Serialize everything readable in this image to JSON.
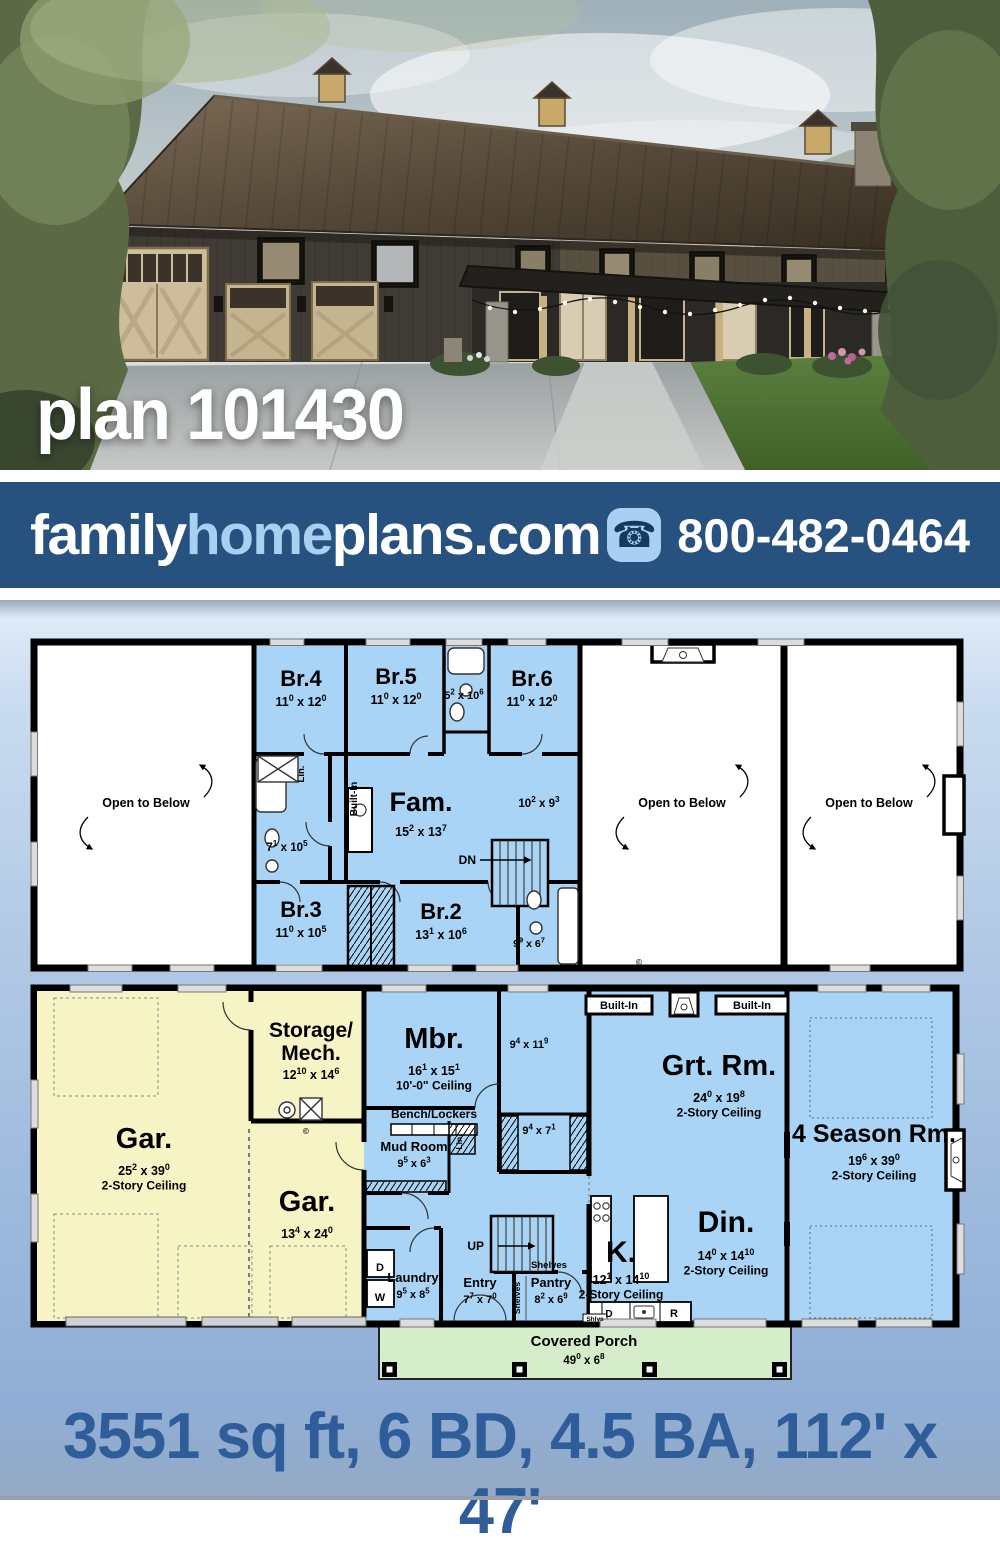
{
  "photo": {
    "title": "plan 101430"
  },
  "banner": {
    "logo_family": "family",
    "logo_home": "home",
    "logo_plans": "plans.com",
    "phone_icon": "phone-icon",
    "phone": "800-482-0464",
    "background": "#27517e",
    "accent": "#a9cff3"
  },
  "footer": {
    "stats": "3551 sq ft, 6 BD, 4.5 BA, 112' x 47'",
    "color": "#2e5d99"
  },
  "colors": {
    "room_fill": "#a9d4f5",
    "garage_fill": "#f6f3c5",
    "porch_fill": "#d6edcb",
    "open_fill": "#ffffff",
    "wall": "#000000"
  },
  "plans": {
    "upper": {
      "labels": [
        {
          "x": 271,
          "y": 48,
          "name": "Br.4",
          "fs": 22,
          "dims": [
            "11",
            "0",
            "12",
            "0"
          ]
        },
        {
          "x": 366,
          "y": 46,
          "name": "Br.5",
          "fs": 22,
          "dims": [
            "11",
            "0",
            "12",
            "0"
          ]
        },
        {
          "x": 434,
          "y": 61,
          "dims": [
            "5",
            "2",
            "10",
            "6"
          ],
          "dfs": 11
        },
        {
          "x": 502,
          "y": 48,
          "name": "Br.6",
          "fs": 22,
          "dims": [
            "11",
            "0",
            "12",
            "0"
          ]
        },
        {
          "x": 391,
          "y": 173,
          "name": "Fam.",
          "fs": 27,
          "dims": [
            "15",
            "2",
            "13",
            "7"
          ]
        },
        {
          "x": 509,
          "y": 169,
          "dims": [
            "10",
            "2",
            "9",
            "3"
          ],
          "dfs": 11.5
        },
        {
          "x": 257,
          "y": 213,
          "dims": [
            "7",
            "1",
            "10",
            "5"
          ],
          "dfs": 11.5
        },
        {
          "x": 271,
          "y": 279,
          "name": "Br.3",
          "fs": 22,
          "dims": [
            "11",
            "0",
            "10",
            "5"
          ]
        },
        {
          "x": 411,
          "y": 281,
          "name": "Br.2",
          "fs": 22,
          "dims": [
            "13",
            "1",
            "10",
            "6"
          ]
        },
        {
          "x": 499,
          "y": 309,
          "dims": [
            "9",
            "9",
            "6",
            "7"
          ],
          "dfs": 10.5
        },
        {
          "x": 116,
          "y": 169,
          "name": "Open to Below",
          "fs": 12.5
        },
        {
          "x": 652,
          "y": 169,
          "name": "Open to Below",
          "fs": 12.5
        },
        {
          "x": 839,
          "y": 169,
          "name": "Open to Below",
          "fs": 12.5
        },
        {
          "x": 446,
          "y": 226,
          "name": "DN",
          "fs": 12,
          "anchor": "end"
        },
        {
          "x": 274,
          "y": 136,
          "name": "Lin.",
          "fs": 9.5,
          "rot": -90
        },
        {
          "x": 327,
          "y": 161,
          "name": "Built-In",
          "fs": 10,
          "rot": -90
        },
        {
          "x": 609,
          "y": 327,
          "name": "©",
          "fs": 8
        }
      ]
    },
    "main": {
      "labels": [
        {
          "x": 114,
          "y": 164,
          "name": "Gar.",
          "fs": 29,
          "dims": [
            "25",
            "2",
            "39",
            "0"
          ],
          "note": "2-Story Ceiling"
        },
        {
          "x": 281,
          "y": 53,
          "lines": [
            "Storage/",
            "Mech."
          ],
          "fs": 21,
          "dims": [
            "12",
            "10",
            "14",
            "6"
          ]
        },
        {
          "x": 277,
          "y": 227,
          "name": "Gar.",
          "fs": 29,
          "dims": [
            "13",
            "4",
            "24",
            "0"
          ]
        },
        {
          "x": 404,
          "y": 64,
          "name": "Mbr.",
          "fs": 29,
          "dims": [
            "16",
            "1",
            "15",
            "1"
          ],
          "note": "10'-0\" Ceiling"
        },
        {
          "x": 499,
          "y": 64,
          "dims": [
            "9",
            "4",
            "11",
            "9"
          ],
          "dfs": 11
        },
        {
          "x": 404,
          "y": 134,
          "name": "Bench/Lockers",
          "fs": 12
        },
        {
          "x": 432,
          "y": 158,
          "name": "Lin.",
          "fs": 8.5,
          "rot": -90
        },
        {
          "x": 384,
          "y": 167,
          "name": "Mud Room",
          "fs": 13,
          "dims": [
            "9",
            "5",
            "6",
            "3"
          ],
          "dfs": 11,
          "dy": 16
        },
        {
          "x": 509,
          "y": 150,
          "dims": [
            "9",
            "4",
            "7",
            "1"
          ],
          "dfs": 11
        },
        {
          "x": 589,
          "y": 25,
          "name": "Built-In",
          "fs": 11
        },
        {
          "x": 722,
          "y": 25,
          "name": "Built-In",
          "fs": 11
        },
        {
          "x": 689,
          "y": 91,
          "name": "Grt. Rm.",
          "fs": 29,
          "dims": [
            "24",
            "0",
            "19",
            "8"
          ],
          "note": "2-Story Ceiling"
        },
        {
          "x": 844,
          "y": 158,
          "name": "4 Season Rm.",
          "fs": 25,
          "dims": [
            "19",
            "6",
            "39",
            "0"
          ],
          "note": "2-Story Ceiling"
        },
        {
          "x": 696,
          "y": 248,
          "name": "Din.",
          "fs": 30,
          "dims": [
            "14",
            "0",
            "14",
            "10"
          ],
          "note": "2-Story Ceiling"
        },
        {
          "x": 591,
          "y": 278,
          "name": "K.",
          "fs": 30,
          "dims": [
            "12",
            "1",
            "14",
            "10"
          ],
          "note": "2-Story Ceiling",
          "dy": 22
        },
        {
          "x": 454,
          "y": 266,
          "name": "UP",
          "fs": 12,
          "anchor": "end"
        },
        {
          "x": 350,
          "y": 287,
          "name": "D",
          "fs": 11
        },
        {
          "x": 350,
          "y": 317,
          "name": "W",
          "fs": 11
        },
        {
          "x": 383,
          "y": 298,
          "name": "Laundry",
          "fs": 13,
          "dims": [
            "9",
            "5",
            "8",
            "5"
          ],
          "dfs": 11,
          "dy": 16
        },
        {
          "x": 450,
          "y": 303,
          "name": "Entry",
          "fs": 13,
          "dims": [
            "7",
            "7",
            "7",
            "0"
          ],
          "dfs": 11,
          "dy": 16
        },
        {
          "x": 490,
          "y": 314,
          "name": "Shelves",
          "fs": 8.5,
          "rot": -90
        },
        {
          "x": 519,
          "y": 284,
          "name": "Shelves",
          "fs": 9.5
        },
        {
          "x": 521,
          "y": 303,
          "name": "Pantry",
          "fs": 13,
          "dims": [
            "8",
            "2",
            "6",
            "9"
          ],
          "dfs": 11,
          "dy": 16
        },
        {
          "x": 565,
          "y": 337,
          "name": "Shlvs",
          "fs": 6.5
        },
        {
          "x": 579,
          "y": 333,
          "name": "D",
          "fs": 10
        },
        {
          "x": 644,
          "y": 333,
          "name": "R",
          "fs": 11
        },
        {
          "x": 554,
          "y": 362,
          "name": "Covered Porch",
          "fs": 15,
          "dims": [
            "49",
            "0",
            "6",
            "8"
          ],
          "dfs": 11.5,
          "dy": 18
        },
        {
          "x": 276,
          "y": 150,
          "name": "©",
          "fs": 8
        }
      ]
    }
  }
}
